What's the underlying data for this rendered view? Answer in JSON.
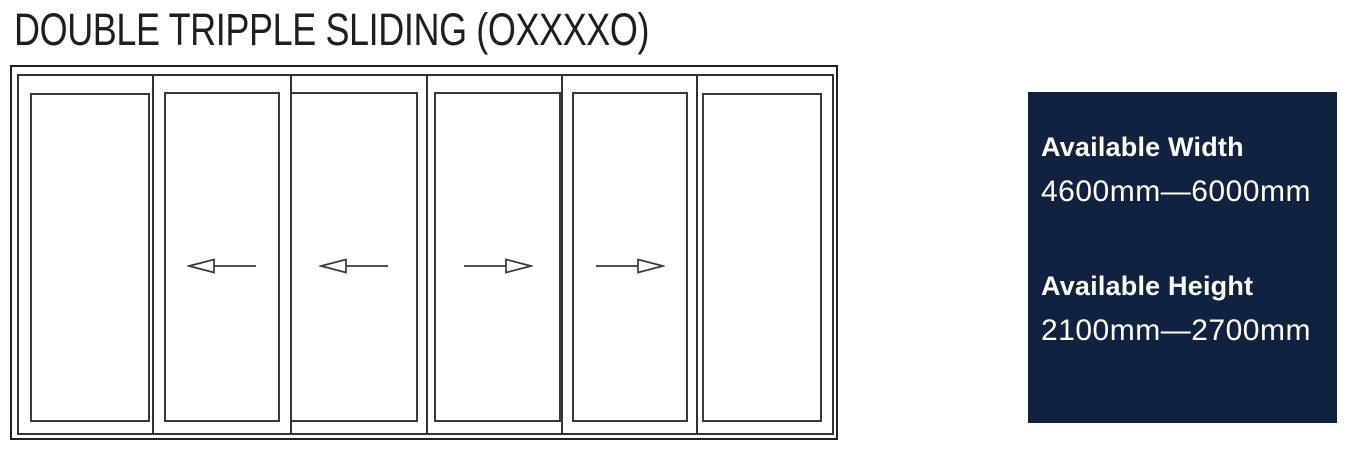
{
  "title": "DOUBLE TRIPPLE SLIDING (OXXXXO)",
  "diagram": {
    "config_code": "OXXXXO",
    "line_color": "#3a3a3a",
    "panels": [
      {
        "label": "O",
        "type": "fixed"
      },
      {
        "label": "X",
        "type": "sliding",
        "direction": "left"
      },
      {
        "label": "X",
        "type": "sliding",
        "direction": "left"
      },
      {
        "label": "X",
        "type": "sliding",
        "direction": "right"
      },
      {
        "label": "X",
        "type": "sliding",
        "direction": "right"
      },
      {
        "label": "O",
        "type": "fixed"
      }
    ]
  },
  "info_panel": {
    "background_color": "#112140",
    "text_color": "#ffffff",
    "blocks": [
      {
        "label": "Available Width",
        "value": "4600mm—6000mm"
      },
      {
        "label": "Available Height",
        "value": "2100mm—2700mm"
      }
    ]
  }
}
